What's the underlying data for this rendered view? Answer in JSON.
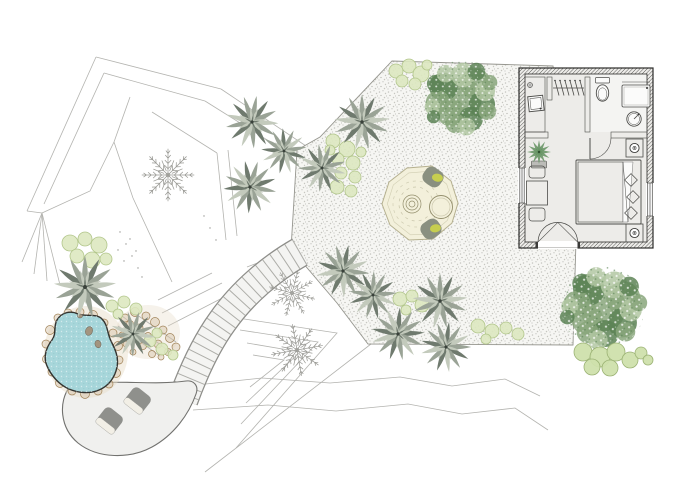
{
  "canvas": {
    "width": 700,
    "height": 500,
    "background": "#ffffff"
  },
  "document_type": "landscape-architecture-site-plan",
  "text_labels": [],
  "colors": {
    "line": "#b3b3af",
    "line_dark": "#979793",
    "gravel": "#f6f6f3",
    "gravel_dot1": "#c6c6c0",
    "gravel_dot2": "#aeaea8",
    "gravel_edge": "#96968f",
    "path": "#f4f4f2",
    "path_edge": "#8e8e8a",
    "tread": "#adada8",
    "patio": "#f0f0ee",
    "patio_edge": "#72726f",
    "chair": "#8f908c",
    "chair_seat": "#f2efe6",
    "pond": "#a7d6da",
    "pond_edge": "#33332f",
    "stone": "#a3947f",
    "pebble": "#d7c6ac",
    "pebble_edge": "#a08257",
    "sand": "#e6dbc6",
    "groundcover": "#dde8c0",
    "groundcover_edge": "#b2c68b",
    "agave_light": "#c3cabc",
    "agave_mid": "#9aa396",
    "agave_dark": "#6f7a6e",
    "agave_core": "#39413a",
    "fern": "#9a9a95",
    "tree_base": "#88a67b",
    "tree_dark": "#5c8355",
    "tree_light": "#b1c7a2",
    "shrub": "#cfe0ac",
    "shrub_edge": "#9bb274",
    "platform": "#f3f0db",
    "platform_edge": "#b5b08f",
    "platform_ring": "#938e6c",
    "cushion": "#c6ce4f",
    "lounge_chair": "#8a9080",
    "wall": "#3a3a38",
    "wall_line": "#2c2c2a",
    "floor": "#edece9",
    "fixture": "#fbfbfa",
    "furniture_line": "#4c4c49",
    "plant_green": "#639260",
    "pot": "#bcbcb8",
    "bed": "#f4f3f1",
    "bed_dot": "#9c9c97",
    "pillow_line": "#72726f",
    "lamp_ring": "#3c3c3a"
  },
  "site": {
    "terrain": {
      "contour_polylines": 29,
      "scatter_dots": 18
    },
    "gravel_terrace": {
      "texture": "stipple",
      "outlined": true
    },
    "stepped_path": {
      "treads_approx": 20,
      "connects": [
        "gravel-terrace",
        "patio"
      ]
    },
    "patio": {
      "chairs": 2
    },
    "pond": {
      "stones": 3,
      "pebble_border": true,
      "pebble_mosaic_fan": true
    },
    "lounge_platform": {
      "lounge_chairs": 2,
      "cushions": 2,
      "side_table": 1,
      "center_feature": "concentric-rings"
    },
    "planting": {
      "agave_rosettes": 12,
      "fern_symbols": 3,
      "canopy_trees": 2,
      "ground_cover_clusters": 7,
      "shrub_cluster_circles": 8
    }
  },
  "building": {
    "rooms": [
      "utility",
      "closet",
      "bathroom",
      "bedroom"
    ],
    "openings": [
      "french-entry-door",
      "bathroom-door",
      "window-left",
      "window-right"
    ],
    "bathroom_fixtures": [
      "toilet",
      "shower-tray",
      "round-basin"
    ],
    "utility_fixtures": [
      "sink",
      "faucet"
    ],
    "closet_items": [
      "hanging-rod",
      "hangers"
    ],
    "bedroom_furniture": [
      "double-bed",
      "pillows",
      "nightstand-top",
      "nightstand-bottom",
      "table-lamps",
      "dining-table",
      "dining-chairs",
      "potted-plant"
    ]
  }
}
